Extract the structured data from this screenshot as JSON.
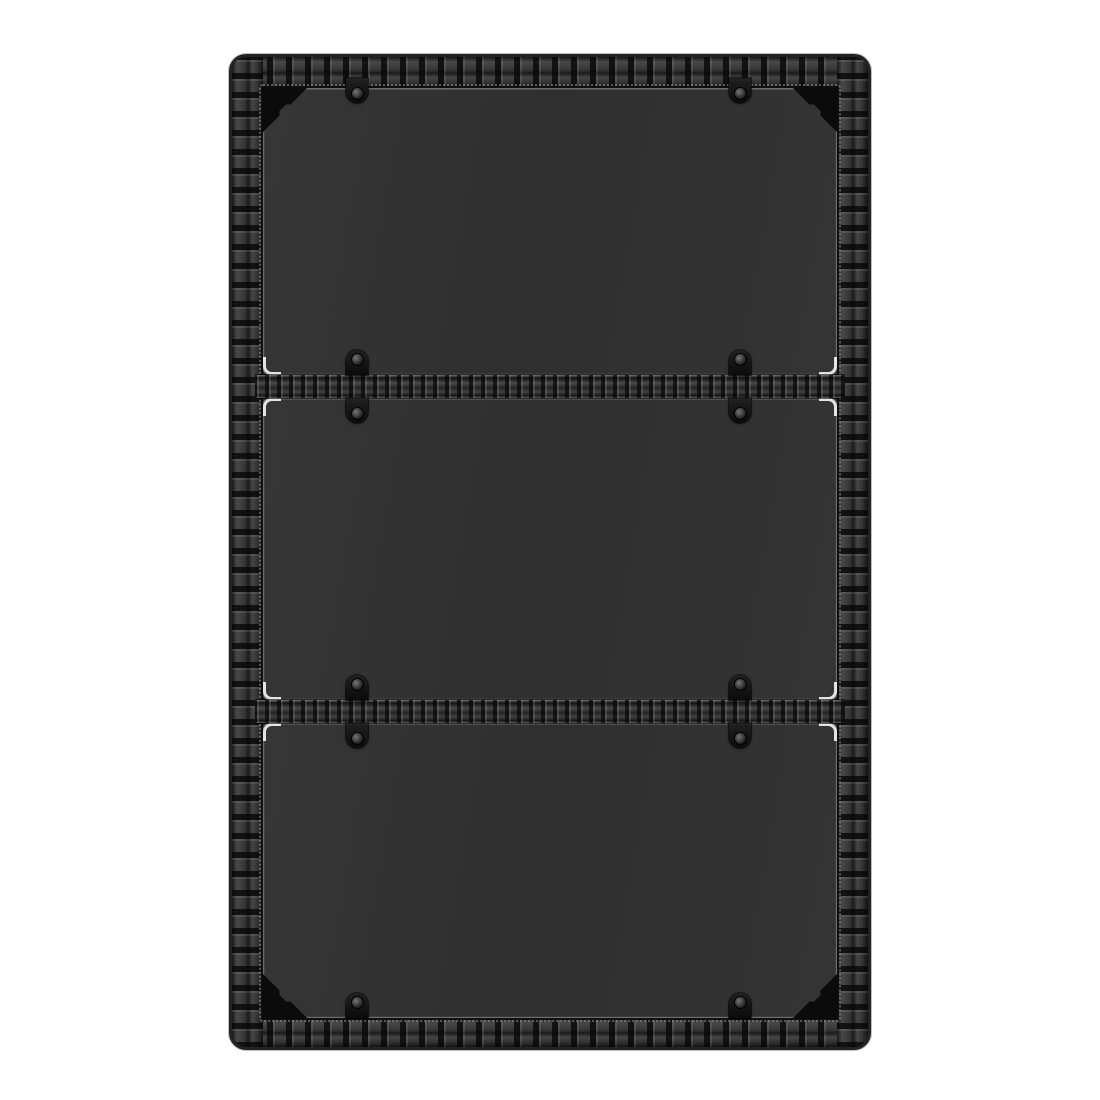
{
  "scene": {
    "type": "product-photo",
    "subject": "Black poly rattan shelf / table unit with three dark tinted glass panels, woven divider bars, black glass clips and corner brackets, photographed front-on against a plain white background",
    "background_color": "#ffffff"
  },
  "palette": {
    "rattan_base": "#262626",
    "rattan_segment_light": "#484848",
    "rattan_gap_dark": "#121212",
    "glass_light": "#363636",
    "glass_dark": "#2f2f2f",
    "glass_edge_line": "#6d6d6d",
    "stitch_highlight": "#b9b9b9",
    "glint_white": "#f5f5f5",
    "clip_black": "#0b0b0b",
    "screw_metal": "#3d3d3d",
    "bracket_black": "#0b0b0b"
  },
  "frame": {
    "left": 232,
    "top": 57,
    "width": 636,
    "height": 990,
    "border_top": 31,
    "border_bottom": 29,
    "border_side": 31,
    "corner_radius": 14
  },
  "glass": {
    "panel_count": 3,
    "panels": [
      {
        "top": 0,
        "height": 287,
        "glints": [
          "bl",
          "br"
        ]
      },
      {
        "top": 310,
        "height": 302,
        "glints": [
          "tl",
          "tr",
          "bl",
          "br"
        ]
      },
      {
        "top": 635,
        "height": 295,
        "glints": [
          "tl",
          "tr"
        ]
      }
    ],
    "dividers": [
      {
        "top": 287,
        "height": 23
      },
      {
        "top": 612,
        "height": 23
      }
    ]
  },
  "hardware": {
    "clip_width": 22,
    "clip_height": 25,
    "clips": [
      {
        "x": 94,
        "top": -10,
        "dir": "down"
      },
      {
        "x": 477,
        "top": -10,
        "dir": "down"
      },
      {
        "x": 94,
        "top": 262,
        "dir": "up"
      },
      {
        "x": 477,
        "top": 262,
        "dir": "up"
      },
      {
        "x": 94,
        "top": 310,
        "dir": "down"
      },
      {
        "x": 477,
        "top": 310,
        "dir": "down"
      },
      {
        "x": 94,
        "top": 587,
        "dir": "up"
      },
      {
        "x": 477,
        "top": 587,
        "dir": "up"
      },
      {
        "x": 94,
        "top": 635,
        "dir": "down"
      },
      {
        "x": 477,
        "top": 635,
        "dir": "down"
      },
      {
        "x": 94,
        "top": 905,
        "dir": "up"
      },
      {
        "x": 477,
        "top": 905,
        "dir": "up"
      }
    ],
    "corner_brackets": [
      "tl",
      "tr",
      "bl",
      "br"
    ],
    "bracket_size": 46
  }
}
